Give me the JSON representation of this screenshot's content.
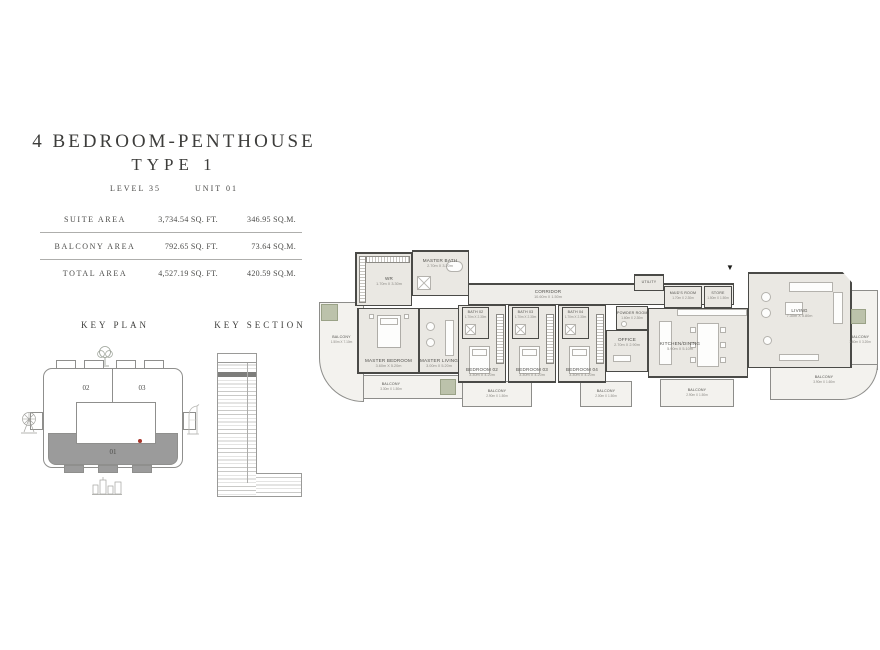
{
  "title": {
    "line1": "4 BEDROOM-PENTHOUSE",
    "line2": "TYPE 1",
    "level": "LEVEL 35",
    "unit": "UNIT 01"
  },
  "area_table": {
    "rows": [
      {
        "label": "SUITE AREA",
        "sqft": "3,734.54 SQ. FT.",
        "sqm": "346.95 SQ.M."
      },
      {
        "label": "BALCONY AREA",
        "sqft": "792.65 SQ. FT.",
        "sqm": "73.64 SQ.M."
      },
      {
        "label": "TOTAL AREA",
        "sqft": "4,527.19 SQ. FT.",
        "sqm": "420.59 SQ.M."
      }
    ]
  },
  "key_plan": {
    "title": "KEY PLAN",
    "unit01": "01",
    "unit02": "02",
    "unit03": "03"
  },
  "key_section": {
    "title": "KEY SECTION"
  },
  "colors": {
    "highlight_red": "#a8362c",
    "unit_shade": "#9b9b9b",
    "section_highlight": "#7d7d7b"
  },
  "floor_plan": {
    "entry_marker": "▼",
    "rooms": {
      "wr": {
        "label": "WR",
        "dims": "1.70m X 3.30m"
      },
      "master_bath": {
        "label": "MASTER BATH",
        "dims": "2.70m X 3.20m"
      },
      "master_bedroom": {
        "label": "MASTER BEDROOM",
        "dims": "3.60m X 5.20m"
      },
      "master_living": {
        "label": "MASTER LIVING",
        "dims": "3.00m X 5.20m"
      },
      "corridor": {
        "label": "CORRIDOR",
        "dims": "10.60m X 1.50m"
      },
      "bath02": {
        "label": "BATH 02",
        "dims": "1.70m X 2.30m"
      },
      "bedroom02": {
        "label": "BEDROOM 02",
        "dims": "3.30m X 4.20m"
      },
      "bath03": {
        "label": "BATH 03",
        "dims": "1.70m X 2.30m"
      },
      "bedroom03": {
        "label": "BEDROOM 03",
        "dims": "3.30m X 4.20m"
      },
      "bath04": {
        "label": "BATH 04",
        "dims": "1.70m X 2.30m"
      },
      "bedroom04": {
        "label": "BEDROOM 04",
        "dims": "3.30m X 4.20m"
      },
      "office": {
        "label": "OFFICE",
        "dims": "2.70m X 2.90m"
      },
      "powder": {
        "label": "POWDER ROOM",
        "dims": "1.60m X 2.30m"
      },
      "utility": {
        "label": "UTILITY",
        "dims": ""
      },
      "maids": {
        "label": "MAID'S ROOM",
        "dims": "1.70m X 2.30m"
      },
      "store": {
        "label": "STORE",
        "dims": "1.50m X 1.50m"
      },
      "kitchen_dining": {
        "label": "KITCHEN/DINING",
        "dims": "5.90m X 5.10m"
      },
      "living": {
        "label": "LIVING",
        "dims": "7.30m X 5.80m"
      },
      "balcony_left": {
        "label": "BALCONY",
        "dims": "1.50m X 7.10m"
      },
      "balcony_master": {
        "label": "BALCONY",
        "dims": "3.30m X 1.50m"
      },
      "balcony_b2": {
        "label": "BALCONY",
        "dims": "2.90m X 1.50m"
      },
      "balcony_b3": {
        "label": "BALCONY",
        "dims": "2.00m X 1.50m"
      },
      "balcony_b4": {
        "label": "BALCONY",
        "dims": "2.90m X 1.50m"
      },
      "balcony_side": {
        "label": "BALCONY",
        "dims": "1.60m X 3.20m"
      },
      "balcony_b5": {
        "label": "BALCONY",
        "dims": "3.90m X 1.60m"
      }
    }
  }
}
